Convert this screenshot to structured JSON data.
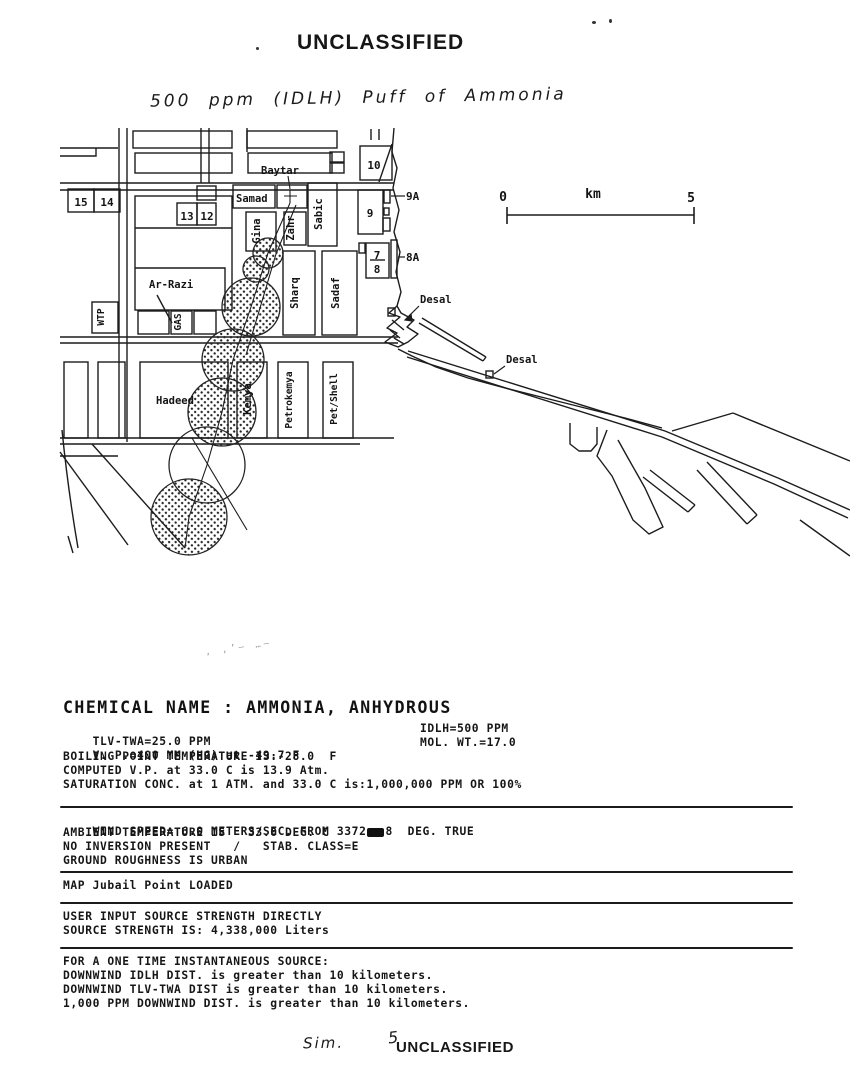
{
  "page": {
    "top_classification": "UNCLASSIFIED",
    "bottom_classification": "UNCLASSIFIED",
    "handwriting": {
      "title": "500 ppm (IDLH) Puff of Ammonia",
      "bottom_note": "Sim.",
      "bottom_number": "5"
    }
  },
  "map": {
    "scale_bar": {
      "start": "0",
      "unit": "km",
      "end": "5"
    },
    "numbered_blocks": {
      "b15": "15",
      "b14": "14",
      "b13": "13",
      "b12": "12",
      "b10": "10",
      "b9": "9",
      "b9a": "9A",
      "b7": "7",
      "b8": "8",
      "b8a": "8A"
    },
    "facilities": {
      "baytar": "Baytar",
      "samad": "Samad",
      "gina": "Gina",
      "zahr": "Zahr",
      "sabic": "Sabic",
      "ar_razi": "Ar-Razi",
      "gas": "GAS",
      "wtp": "WTP",
      "sharq": "Sharq",
      "sadaf": "Sadaf",
      "hadeed": "Hadeed",
      "kemya": "Kemya",
      "petrokemya": "Petrokemya",
      "pet_shell": "Pet/Shell",
      "desal_plant": "Desal",
      "desal_intake": "Desal"
    }
  },
  "report": {
    "title": "CHEMICAL NAME : AMMONIA, ANHYDROUS",
    "chem": {
      "rows": [
        {
          "left": "TLV-TWA=25.0 PPM",
          "right": "IDLH=500 PPM"
        },
        {
          "left": "V. P.=400 MM (HG) at -49.7 F",
          "right": "MOL. WT.=17.0"
        },
        {
          "left": "BOILING POINT TEMPERATURE IS:-28.0  F"
        },
        {
          "left": "COMPUTED V.P. at 33.0 C is 13.9 Atm."
        },
        {
          "left": "SATURATION CONC. at 1 ATM. and 33.0 C is:1,000,000 PPM OR 100%"
        }
      ]
    },
    "weather": {
      "wind_prefix": "WIND SPEED= 6.0 METERS/SEC. FROM 337",
      "wind_overstruck": "2",
      "wind_suffix": "8  DEG. TRUE",
      "rows": [
        "AMBIENT TEMPERATURE IS   33.0 DEG. C",
        "NO INVERSION PRESENT   /   STAB. CLASS=E",
        "GROUND ROUGHNESS IS URBAN"
      ]
    },
    "map_status": "MAP Jubail Point LOADED",
    "source": {
      "rows": [
        "USER INPUT SOURCE STRENGTH DIRECTLY",
        "SOURCE STRENGTH IS: 4,338,000 Liters"
      ]
    },
    "results": {
      "header": "FOR A ONE TIME INSTANTANEOUS SOURCE:",
      "rows": [
        "DOWNWIND IDLH DIST. is greater than 10 kilometers.",
        "DOWNWIND TLV-TWA DIST is greater than 10 kilometers.",
        "1,000 PPM DOWNWIND DIST. is greater than 10 kilometers."
      ]
    }
  }
}
